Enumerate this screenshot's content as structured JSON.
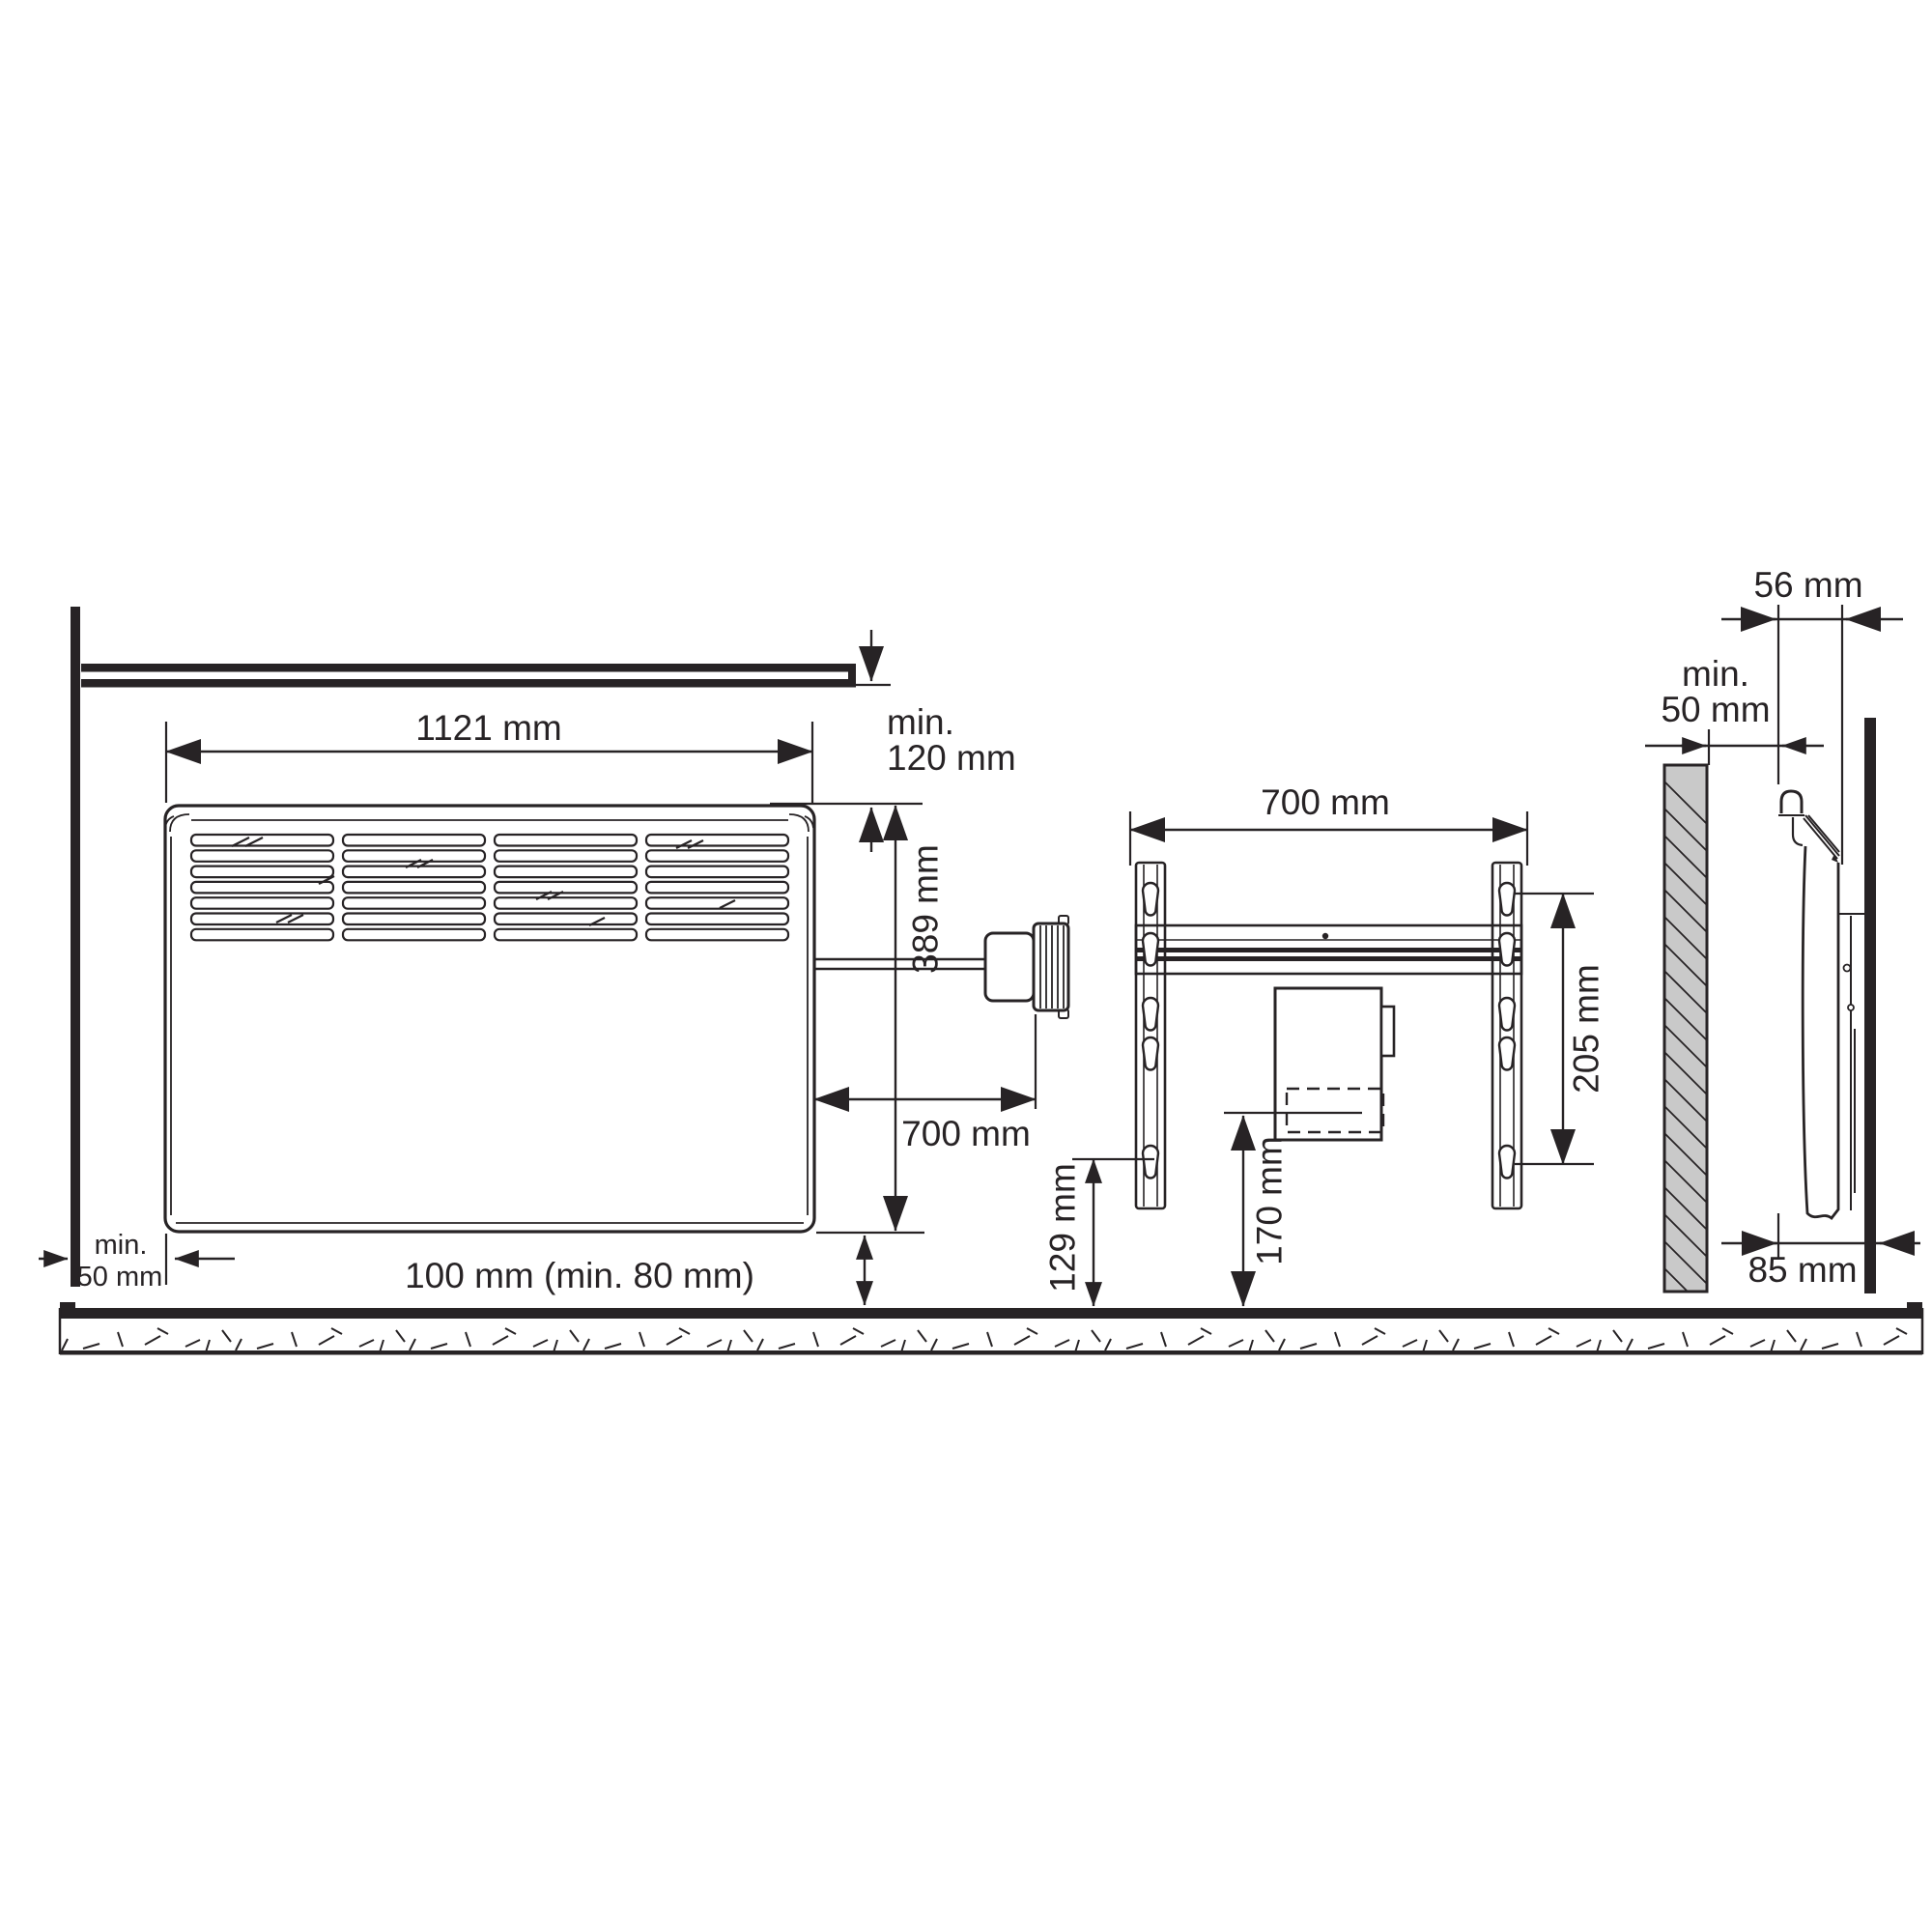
{
  "diagram": {
    "subject": "wall-mounted convector heater installation dimensions",
    "front_view": {
      "width": "1121 mm",
      "height": "389 mm",
      "top_clearance_min": "min.",
      "top_clearance_value": "120 mm",
      "cable_length": "700 mm",
      "bottom_clearance": "100 mm (min. 80 mm)",
      "side_clearance_min": "min.",
      "side_clearance_value": "50 mm"
    },
    "bracket_view": {
      "width": "700 mm",
      "keyhole_span": "205 mm",
      "lower_keyhole_to_floor": "129 mm",
      "junction_box_line_to_floor": "170 mm"
    },
    "side_view": {
      "heater_depth": "56 mm",
      "front_clearance_min": "min.",
      "front_clearance_value": "50 mm",
      "wall_to_front_face": "85 mm"
    }
  },
  "colors": {
    "line": "#272325",
    "hatch_fill": "#c9c9c9",
    "background": "#ffffff"
  }
}
